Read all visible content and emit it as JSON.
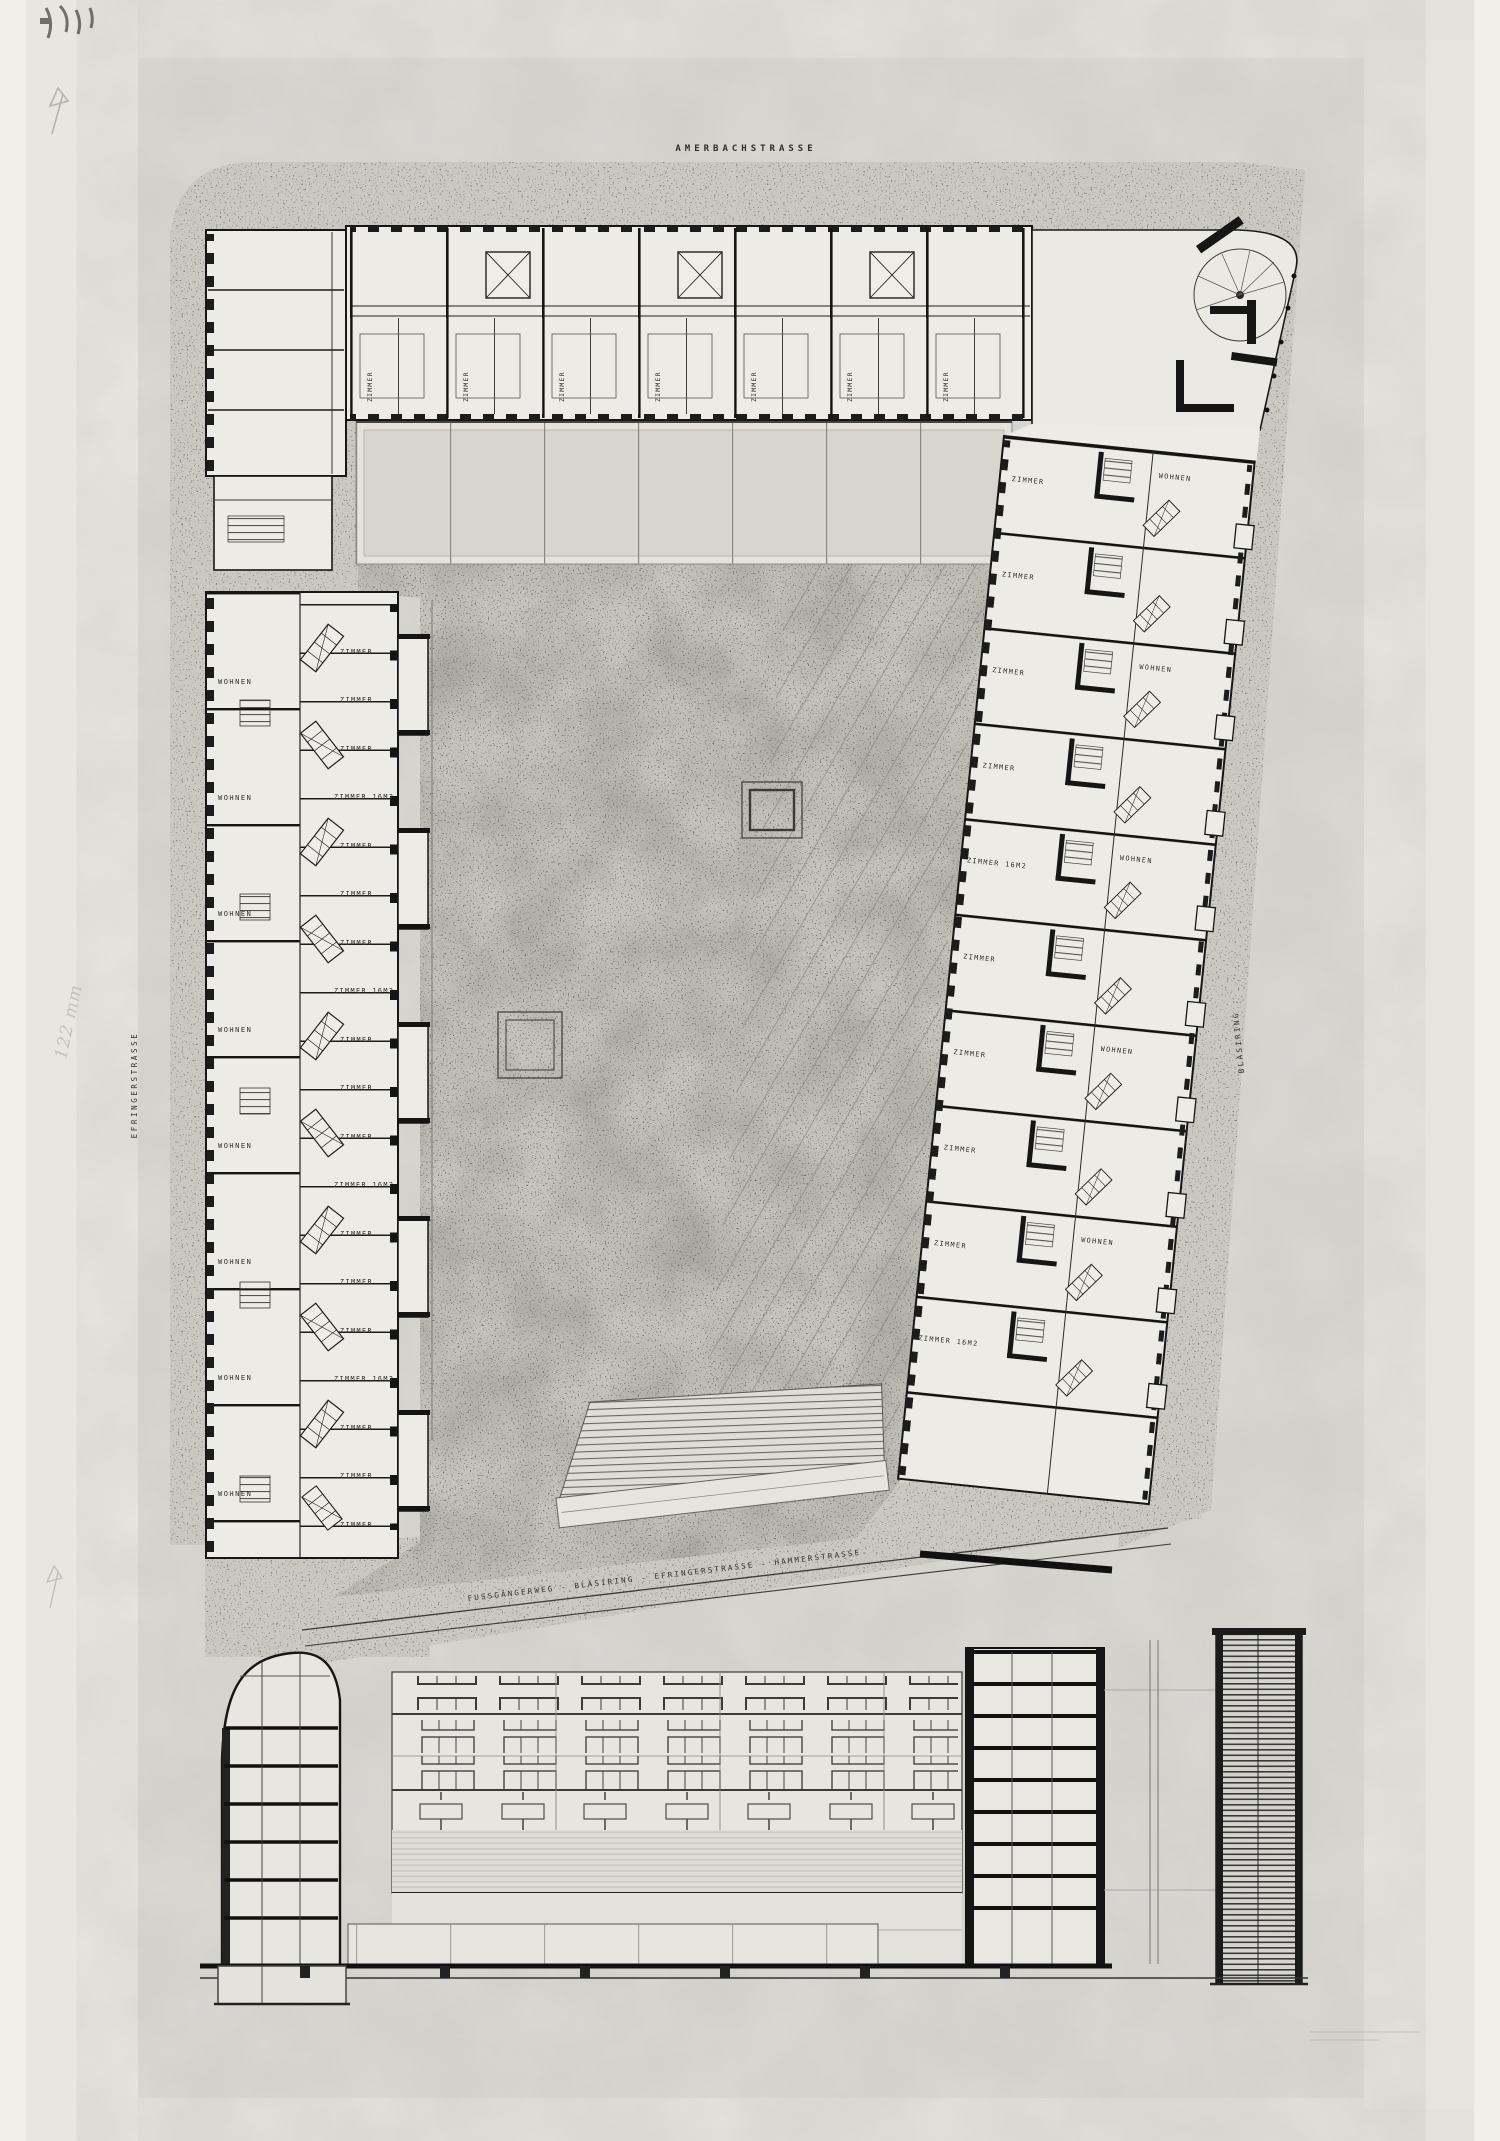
{
  "sheet": {
    "streets": {
      "top": "AMERBACHSTRASSE",
      "left": "EFRINGERSTRASSE",
      "right": "BLÄSIRING",
      "footpath": "FUSSGÄNGERWEG - BLÄSIRING - EFRINGERSTRASSE - HAMMERSTRASSE"
    },
    "rooms": {
      "wohnen": "WOHNEN",
      "zimmer": "ZIMMER",
      "zimmer_area": "ZIMMER 16M2"
    },
    "annotations": {
      "pencil_note": "122 mm"
    }
  }
}
